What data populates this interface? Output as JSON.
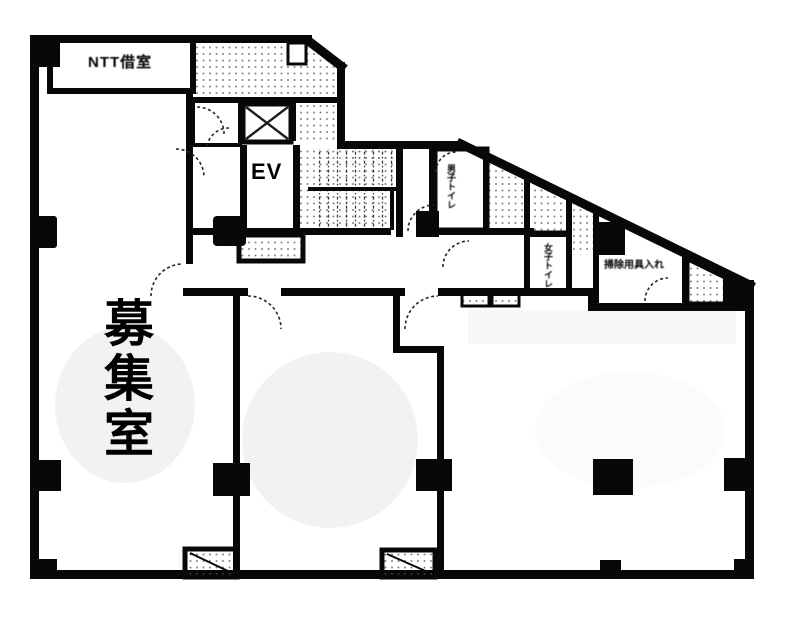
{
  "plan": {
    "rooms": {
      "ntt_room_label": "NTT借室",
      "elevator_label": "EV",
      "vacant_room_label": "募集室",
      "mens_toilet_label": "男子トイレ",
      "womens_toilet_label": "女子トイレ",
      "utility_room_label": "掃除用具入れ"
    },
    "colors": {
      "wall": "#0e0e0e",
      "hatch_dot": "#5a5a5a",
      "shade": "#ededed",
      "overlay_text": "#000000"
    }
  }
}
